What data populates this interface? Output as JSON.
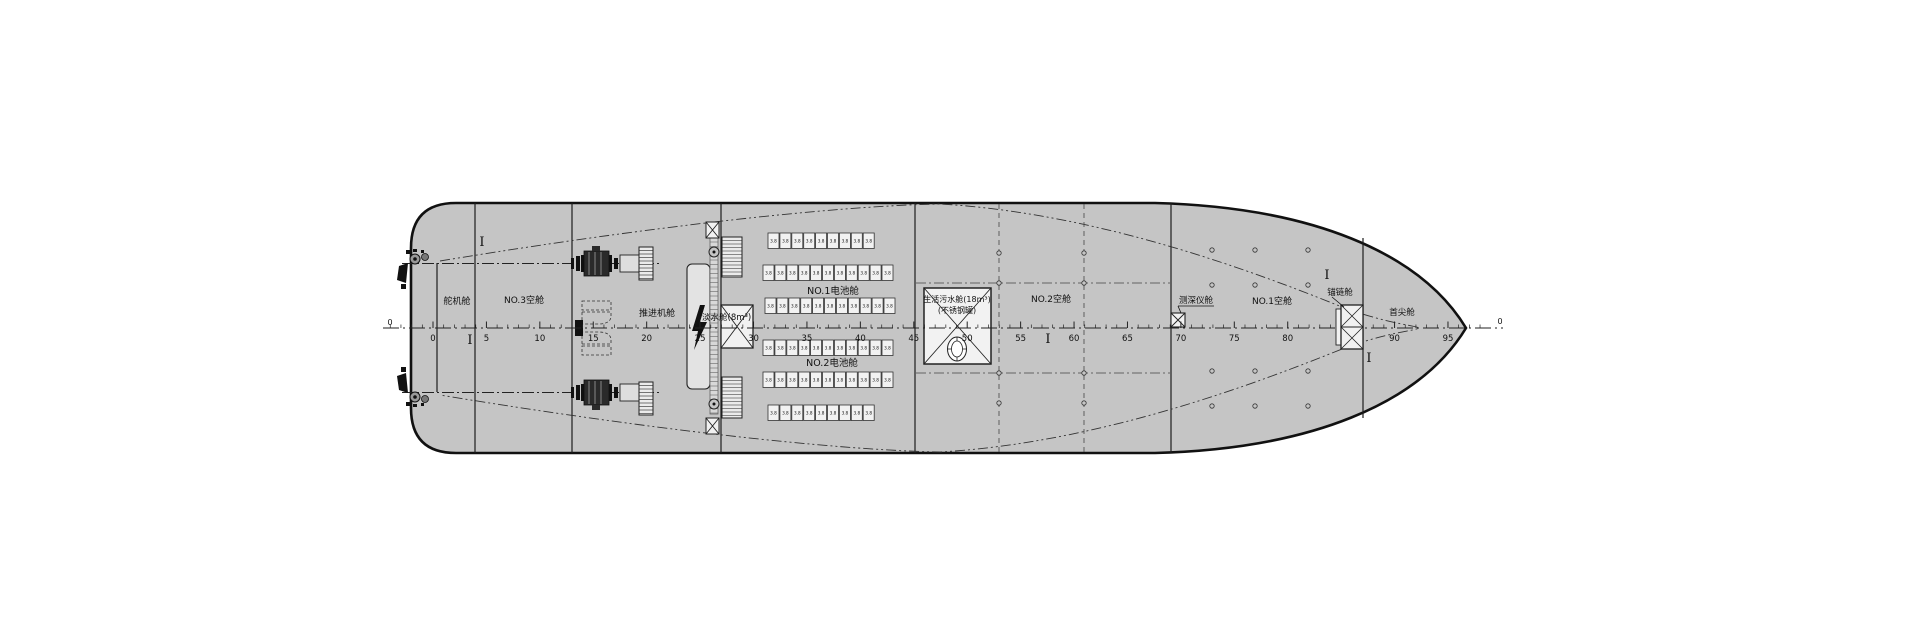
{
  "compartments": {
    "rudder_room": "舵机舱",
    "void_no3": "NO.3空舱",
    "propulsion_room": "推进机舱",
    "battery_no1": "NO.1电池舱",
    "battery_no2": "NO.2电池舱",
    "fresh_water_tank": "淡水舱(8m³)",
    "sewage_tank_line1": "生活污水舱(18m³)",
    "sewage_tank_line2": "(不锈钢罐)",
    "void_no2": "NO.2空舱",
    "sounder_room": "测深仪舱",
    "void_no1": "NO.1空舱",
    "chain_locker": "锚链舱",
    "fore_peak": "首尖舱"
  },
  "section_marks": {
    "s1": "I",
    "s2": "I",
    "s3": "I",
    "s4": "I",
    "s5": "I"
  },
  "frame_scale": {
    "labels": [
      "0",
      "5",
      "10",
      "15",
      "20",
      "25",
      "30",
      "35",
      "40",
      "45",
      "50",
      "55",
      "60",
      "65",
      "70",
      "75",
      "80",
      "85",
      "90",
      "95"
    ],
    "left_end_label": "0",
    "right_end_label": "0"
  },
  "battery": {
    "cell_label": "3.8",
    "rows": [
      {
        "count": 9
      },
      {
        "count": 11
      },
      {
        "count": 11
      },
      {
        "count": 11
      },
      {
        "count": 11
      },
      {
        "count": 9
      }
    ]
  },
  "colors": {
    "background": "#ffffff",
    "deck": "#c5c5c5",
    "hull_line": "#111111",
    "light_fill": "#f1f1f1"
  }
}
